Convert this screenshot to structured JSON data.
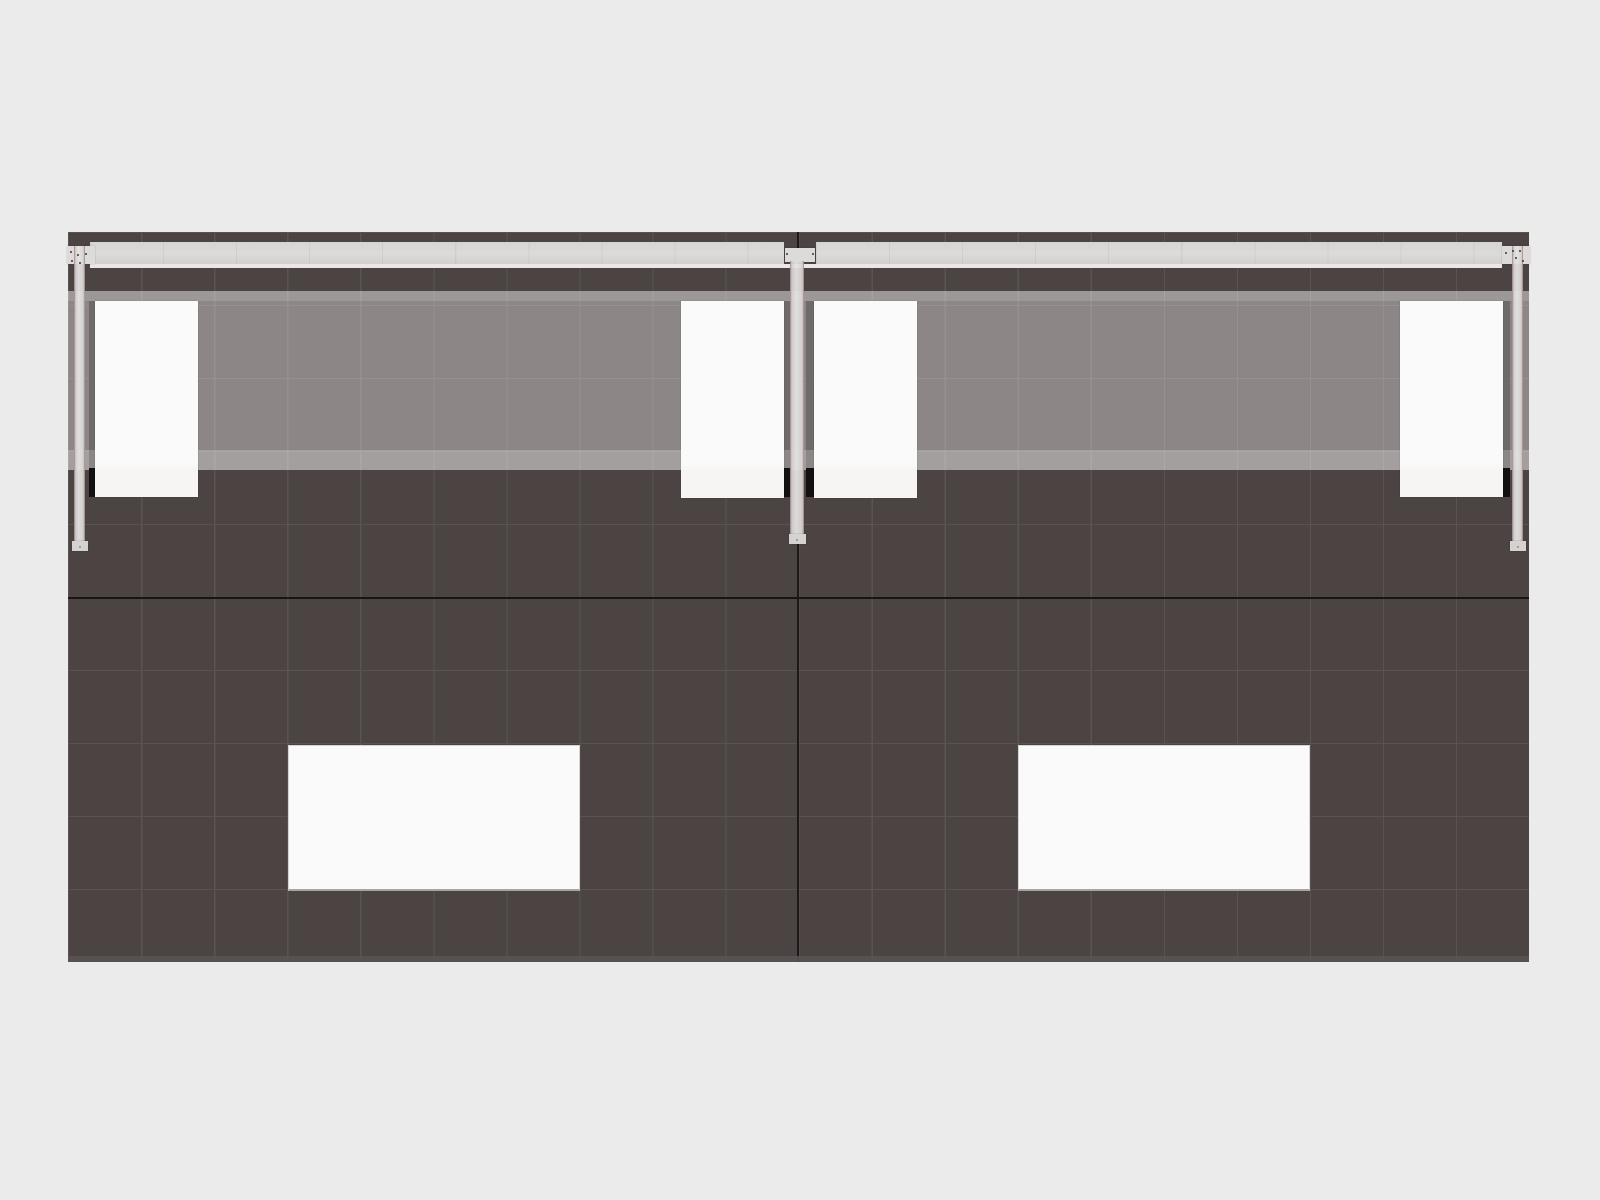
{
  "canvas": {
    "width": 1600,
    "height": 1200
  },
  "scene_label": "exhibit-wall-elevation-render",
  "colors": {
    "background": "#ebebeb",
    "wall": "#4b4443",
    "grid_line": "#5a5352",
    "seam": "#1a1515",
    "edge_trim": "#5a5454",
    "shadow": "#1a1515",
    "rail": "#dcdbda",
    "panel": "#fbfafa",
    "bolt": "#3c3636",
    "accent_red": "rgba(138,82,82,0.45)"
  },
  "grid": {
    "columns": 20,
    "rows": 10,
    "cell_w": 73.05,
    "cell_h": 73
  },
  "elements": [
    {
      "name": "exhibit-wall",
      "cls": "wall",
      "x": 68,
      "y": 232,
      "w": 1461,
      "h": 730
    },
    {
      "name": "horizontal-seam",
      "cls": "seam-h",
      "x": 68,
      "y": 596.5,
      "w": 1461,
      "h": 2.6
    },
    {
      "name": "center-seam",
      "cls": "seam-v",
      "x": 797.4,
      "y": 232,
      "w": 2,
      "h": 730
    },
    {
      "name": "bottom-edge-trim",
      "cls": "edge-trim",
      "x": 68,
      "y": 956,
      "w": 1461,
      "h": 6
    },
    {
      "name": "monitor-shadow-left-outer",
      "cls": "shadow",
      "x": 89,
      "y": 301,
      "w": 6.5,
      "h": 196
    },
    {
      "name": "monitor-shadow-left-inner",
      "cls": "shadow",
      "x": 783,
      "y": 301,
      "w": 7.5,
      "h": 196
    },
    {
      "name": "monitor-shadow-right-inner",
      "cls": "shadow",
      "x": 805.5,
      "y": 301,
      "w": 8,
      "h": 196
    },
    {
      "name": "monitor-shadow-right-outer",
      "cls": "shadow",
      "x": 1503,
      "y": 301,
      "w": 7,
      "h": 196
    },
    {
      "name": "glass-header-band",
      "cls": "band",
      "x": 68,
      "y": 291,
      "w": 1461,
      "h": 179
    },
    {
      "name": "band-top-highlight",
      "cls": "band-top",
      "x": 68,
      "y": 291,
      "w": 1461,
      "h": 10
    },
    {
      "name": "band-bottom-highlight",
      "cls": "band-bot",
      "x": 68,
      "y": 450,
      "w": 1461,
      "h": 20
    },
    {
      "name": "monitor-shadow-dark-left-outer",
      "cls": "shadow-dark",
      "x": 89,
      "y": 468,
      "w": 6.5,
      "h": 29
    },
    {
      "name": "monitor-shadow-dark-left-inner",
      "cls": "shadow-dark",
      "x": 783,
      "y": 468,
      "w": 7.5,
      "h": 29
    },
    {
      "name": "monitor-shadow-dark-right-inner",
      "cls": "shadow-dark",
      "x": 805.5,
      "y": 468,
      "w": 8,
      "h": 29
    },
    {
      "name": "monitor-shadow-dark-right-outer",
      "cls": "shadow-dark",
      "x": 1503,
      "y": 468,
      "w": 7,
      "h": 29
    },
    {
      "name": "display-panel-1",
      "cls": "panel",
      "x": 94.5,
      "y": 301,
      "w": 103,
      "h": 196
    },
    {
      "name": "display-panel-2",
      "cls": "panel",
      "x": 681,
      "y": 301,
      "w": 102.5,
      "h": 196.5
    },
    {
      "name": "display-panel-3",
      "cls": "panel",
      "x": 813.5,
      "y": 301,
      "w": 103,
      "h": 196.5
    },
    {
      "name": "display-panel-4",
      "cls": "panel",
      "x": 1400,
      "y": 301,
      "w": 103,
      "h": 196
    },
    {
      "name": "counter-insert-left",
      "cls": "table",
      "x": 287.5,
      "y": 744.5,
      "w": 292,
      "h": 146
    },
    {
      "name": "counter-insert-right",
      "cls": "table",
      "x": 1017.5,
      "y": 744.5,
      "w": 292,
      "h": 146
    },
    {
      "name": "top-rail-left",
      "cls": "rail",
      "x": 90,
      "y": 242,
      "w": 694,
      "h": 22
    },
    {
      "name": "top-rail-right",
      "cls": "rail",
      "x": 816,
      "y": 242,
      "w": 686,
      "h": 22
    },
    {
      "name": "rail-bottom-highlight",
      "cls": "rail-hl",
      "x": 90,
      "y": 264,
      "w": 1412,
      "h": 3.5
    },
    {
      "name": "rail-plate-left",
      "cls": "plate",
      "x": 67,
      "y": 246,
      "w": 28,
      "h": 18
    },
    {
      "name": "rail-plate-center",
      "cls": "plate",
      "x": 785,
      "y": 248,
      "w": 30,
      "h": 14
    },
    {
      "name": "rail-plate-right",
      "cls": "plate",
      "x": 1502,
      "y": 246,
      "w": 28,
      "h": 18
    },
    {
      "name": "support-post-left",
      "cls": "post",
      "x": 74,
      "y": 246,
      "w": 11,
      "h": 297
    },
    {
      "name": "support-post-center",
      "cls": "post",
      "x": 790,
      "y": 261,
      "w": 14,
      "h": 277
    },
    {
      "name": "support-post-right",
      "cls": "post",
      "x": 1512,
      "y": 246,
      "w": 11,
      "h": 297
    },
    {
      "name": "post-foot-left",
      "cls": "foot",
      "x": 71.5,
      "y": 541,
      "w": 16,
      "h": 10
    },
    {
      "name": "post-foot-center",
      "cls": "foot",
      "x": 788.5,
      "y": 534,
      "w": 17,
      "h": 10
    },
    {
      "name": "post-foot-right",
      "cls": "foot",
      "x": 1509.5,
      "y": 541,
      "w": 16,
      "h": 10
    },
    {
      "name": "bolt",
      "cls": "bolt",
      "x": 69.5,
      "y": 251,
      "w": 2.4,
      "h": 2.4
    },
    {
      "name": "bolt",
      "cls": "bolt",
      "x": 77,
      "y": 253.5,
      "w": 2.4,
      "h": 2.4
    },
    {
      "name": "bolt",
      "cls": "bolt",
      "x": 85,
      "y": 252.5,
      "w": 2.4,
      "h": 2.4
    },
    {
      "name": "bolt",
      "cls": "bolt",
      "x": 71,
      "y": 260,
      "w": 2.4,
      "h": 2.4
    },
    {
      "name": "bolt",
      "cls": "bolt",
      "x": 79,
      "y": 261.5,
      "w": 2.4,
      "h": 2.4
    },
    {
      "name": "bolt",
      "cls": "bolt",
      "x": 786,
      "y": 252.5,
      "w": 2.4,
      "h": 2.4
    },
    {
      "name": "bolt",
      "cls": "bolt",
      "x": 811.5,
      "y": 252.5,
      "w": 2.4,
      "h": 2.4
    },
    {
      "name": "bolt",
      "cls": "bolt",
      "x": 1505,
      "y": 252,
      "w": 2.4,
      "h": 2.4
    },
    {
      "name": "bolt",
      "cls": "bolt",
      "x": 1512,
      "y": 250,
      "w": 2.4,
      "h": 2.4
    },
    {
      "name": "bolt",
      "cls": "bolt",
      "x": 1519,
      "y": 249.5,
      "w": 2.4,
      "h": 2.4
    },
    {
      "name": "bolt",
      "cls": "bolt",
      "x": 1515,
      "y": 257,
      "w": 2.4,
      "h": 2.4
    },
    {
      "name": "bolt",
      "cls": "bolt",
      "x": 1521.5,
      "y": 259.5,
      "w": 2.4,
      "h": 2.4
    },
    {
      "name": "foot-bolt-left",
      "cls": "dot",
      "x": 78.5,
      "y": 545.5,
      "w": 2.5,
      "h": 2.5
    },
    {
      "name": "foot-bolt-center",
      "cls": "dot",
      "x": 795.5,
      "y": 538.5,
      "w": 2.5,
      "h": 2.5
    },
    {
      "name": "foot-bolt-right",
      "cls": "dot",
      "x": 1516.5,
      "y": 545.5,
      "w": 2.5,
      "h": 2.5
    }
  ]
}
